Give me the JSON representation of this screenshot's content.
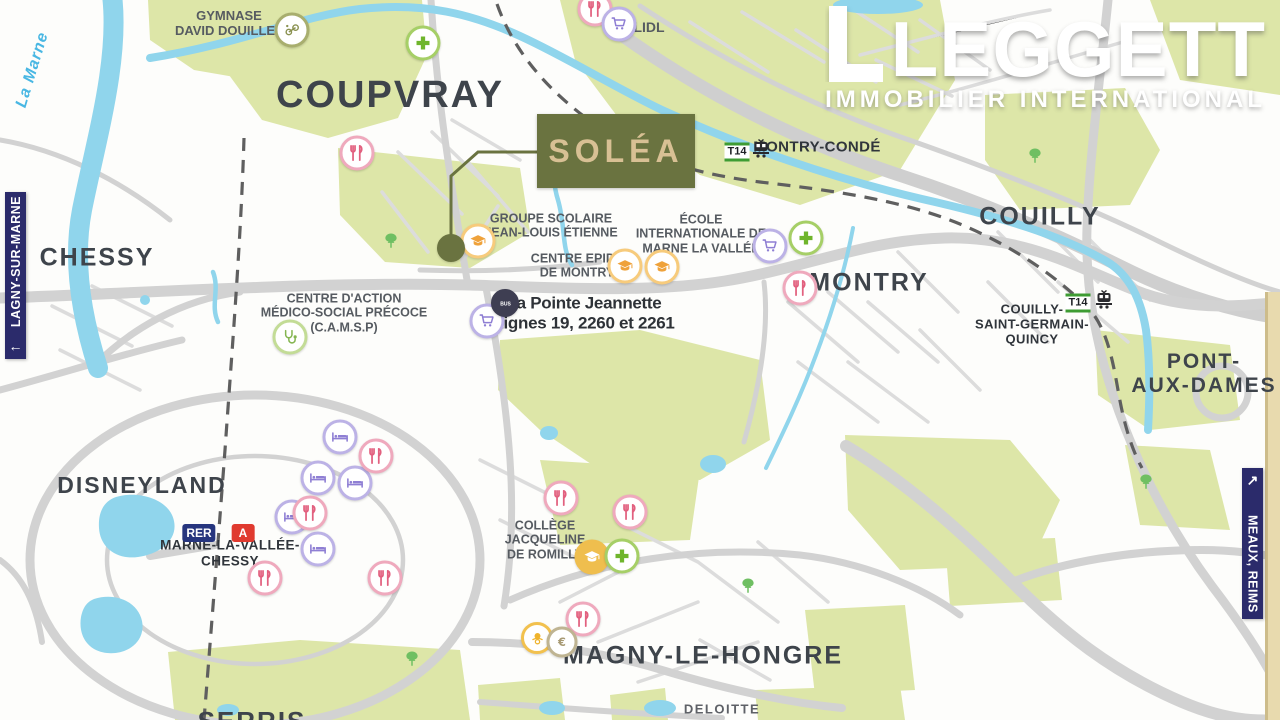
{
  "brand": {
    "name": "LEGGETT",
    "tagline": "IMMOBILIER INTERNATIONAL"
  },
  "property": {
    "name": "SOLÉA"
  },
  "banners": {
    "left": {
      "label": "LAGNY-SUR-MARNE",
      "arrow": "←"
    },
    "right": {
      "label": "MEAUX, REIMS",
      "arrow": "↗"
    }
  },
  "colors": {
    "accent_olive": "#6A7340",
    "navy": "#2B2B6B",
    "green_area": "#DDE6A8",
    "water": "#90D5EC",
    "road": "#D4D4D4",
    "line_a_red": "#E03A2F",
    "t14_green": "#3E9C33"
  },
  "map": {
    "labels": [
      {
        "name": "label-la-marne",
        "cls": "river",
        "lines": [
          "La Marne"
        ],
        "x": 33,
        "y": 70,
        "size": 16,
        "rot": -73
      },
      {
        "name": "label-gymnase-david-douillet",
        "cls": "poi",
        "lines": [
          "GYMNASE",
          "DAVID DOUILLET"
        ],
        "x": 229,
        "y": 24,
        "size": 13
      },
      {
        "name": "label-coupvray",
        "cls": "town",
        "lines": [
          "COUPVRAY"
        ],
        "x": 390,
        "y": 96,
        "size": 38
      },
      {
        "name": "label-conde-sainte-libiaire",
        "cls": "town2",
        "lines": [
          "CONDÉ-SAINTE-LIBIAIRE"
        ],
        "x": 1120,
        "y": -7,
        "size": 20
      },
      {
        "name": "label-lidl",
        "cls": "poi",
        "lines": [
          "LIDL"
        ],
        "x": 649,
        "y": 27,
        "size": 14
      },
      {
        "name": "label-montry-conde",
        "cls": "town2",
        "lines": [
          "MONTRY-CONDÉ"
        ],
        "x": 817,
        "y": 147,
        "size": 15
      },
      {
        "name": "label-chessy",
        "cls": "town",
        "lines": [
          "CHESSY"
        ],
        "x": 97,
        "y": 258,
        "size": 25
      },
      {
        "name": "label-groupe-scolaire",
        "cls": "poi",
        "lines": [
          "GROUPE SCOLAIRE",
          "JEAN-LOUIS ÉTIENNE"
        ],
        "x": 551,
        "y": 226,
        "size": 12.5
      },
      {
        "name": "label-ecole-internationale",
        "cls": "poi",
        "lines": [
          "ÉCOLE",
          "INTERNATIONALE DE",
          "MARNE LA VALLÉE"
        ],
        "x": 701,
        "y": 234,
        "size": 12.5
      },
      {
        "name": "label-centre-epide",
        "cls": "poi",
        "lines": [
          "CENTRE EPIDE",
          "DE MONTRY"
        ],
        "x": 577,
        "y": 266,
        "size": 12.5
      },
      {
        "name": "label-camsp",
        "cls": "poi",
        "lines": [
          "CENTRE D'ACTION",
          "MÉDICO-SOCIAL PRÉCOCE",
          "(C.A.M.S.P)"
        ],
        "x": 344,
        "y": 313,
        "size": 12.5
      },
      {
        "name": "label-pointe-jeannette",
        "cls": "busstop",
        "lines": [
          "La Pointe Jeannette",
          "Lignes 19, 2260 et 2261"
        ],
        "x": 584,
        "y": 313,
        "size": 17
      },
      {
        "name": "label-montry",
        "cls": "town",
        "lines": [
          "MONTRY"
        ],
        "x": 869,
        "y": 283,
        "size": 25
      },
      {
        "name": "label-couilly",
        "cls": "town",
        "lines": [
          "COUILLY"
        ],
        "x": 1040,
        "y": 217,
        "size": 25
      },
      {
        "name": "label-couilly-saint-germain-quincy",
        "cls": "town2",
        "lines": [
          "COUILLY-",
          "SAINT-GERMAIN-",
          "QUINCY"
        ],
        "x": 1032,
        "y": 325,
        "size": 13
      },
      {
        "name": "label-pont-aux-dames",
        "cls": "town",
        "lines": [
          "PONT-",
          "AUX-DAMES"
        ],
        "x": 1204,
        "y": 374,
        "size": 21
      },
      {
        "name": "label-disneyland",
        "cls": "town",
        "lines": [
          "DISNEYLAND"
        ],
        "x": 142,
        "y": 485,
        "size": 23
      },
      {
        "name": "label-marne-la-vallee-chessy",
        "cls": "town2",
        "lines": [
          "MARNE-LA-VALLÉE-",
          "CHESSY"
        ],
        "x": 230,
        "y": 553,
        "size": 13.5
      },
      {
        "name": "label-college-romilly",
        "cls": "poi",
        "lines": [
          "COLLÈGE",
          "JACQUELINE",
          "DE ROMILLY"
        ],
        "x": 545,
        "y": 540,
        "size": 12.5
      },
      {
        "name": "label-magny-le-hongre",
        "cls": "town",
        "lines": [
          "MAGNY-LE-HONGRE"
        ],
        "x": 703,
        "y": 656,
        "size": 25
      },
      {
        "name": "label-serris",
        "cls": "town",
        "lines": [
          "SERRIS"
        ],
        "x": 252,
        "y": 722,
        "size": 26
      },
      {
        "name": "label-deloitte",
        "cls": "company",
        "lines": [
          "DELOITTE"
        ],
        "x": 722,
        "y": 710,
        "size": 13
      }
    ],
    "icons": [
      {
        "type": "sports",
        "x": 292,
        "y": 30
      },
      {
        "type": "pharmacy",
        "x": 423,
        "y": 43
      },
      {
        "type": "restaurant",
        "x": 595,
        "y": 9
      },
      {
        "type": "cart",
        "x": 619,
        "y": 24
      },
      {
        "type": "restaurant",
        "x": 357,
        "y": 153
      },
      {
        "type": "school",
        "x": 478,
        "y": 241
      },
      {
        "type": "school",
        "x": 625,
        "y": 266
      },
      {
        "type": "school",
        "x": 662,
        "y": 267
      },
      {
        "type": "cart",
        "x": 770,
        "y": 246
      },
      {
        "type": "pharmacy",
        "x": 806,
        "y": 238
      },
      {
        "type": "restaurant",
        "x": 800,
        "y": 288
      },
      {
        "type": "medical",
        "x": 290,
        "y": 337
      },
      {
        "type": "cart",
        "x": 487,
        "y": 321
      },
      {
        "type": "bus",
        "x": 505,
        "y": 303
      },
      {
        "type": "bed",
        "x": 340,
        "y": 437
      },
      {
        "type": "bed",
        "x": 318,
        "y": 478
      },
      {
        "type": "bed",
        "x": 355,
        "y": 483
      },
      {
        "type": "bed",
        "x": 292,
        "y": 517
      },
      {
        "type": "bed",
        "x": 318,
        "y": 549
      },
      {
        "type": "restaurant",
        "x": 376,
        "y": 456
      },
      {
        "type": "restaurant",
        "x": 310,
        "y": 513
      },
      {
        "type": "restaurant",
        "x": 265,
        "y": 578
      },
      {
        "type": "restaurant",
        "x": 385,
        "y": 578
      },
      {
        "type": "restaurant",
        "x": 561,
        "y": 498
      },
      {
        "type": "restaurant",
        "x": 630,
        "y": 512
      },
      {
        "type": "school-filled",
        "x": 592,
        "y": 557
      },
      {
        "type": "pharmacy",
        "x": 622,
        "y": 556
      },
      {
        "type": "restaurant",
        "x": 583,
        "y": 619
      },
      {
        "type": "creche",
        "x": 537,
        "y": 638
      },
      {
        "type": "bank",
        "x": 562,
        "y": 642
      },
      {
        "type": "marker",
        "x": 451,
        "y": 248
      },
      {
        "type": "tree",
        "x": 391,
        "y": 241
      },
      {
        "type": "tree",
        "x": 1035,
        "y": 156
      },
      {
        "type": "tree",
        "x": 1146,
        "y": 482
      },
      {
        "type": "tree",
        "x": 748,
        "y": 586
      },
      {
        "type": "tree",
        "x": 412,
        "y": 659
      }
    ],
    "transit": [
      {
        "type": "t14-badge",
        "label": "T14",
        "x": 737,
        "y": 152
      },
      {
        "type": "train-icon",
        "x": 761,
        "y": 151
      },
      {
        "type": "t14-badge",
        "label": "T14",
        "x": 1078,
        "y": 303
      },
      {
        "type": "train-icon",
        "x": 1104,
        "y": 302
      },
      {
        "type": "rer-badge",
        "label": "RER",
        "x": 199,
        "y": 533
      },
      {
        "type": "line-a-badge",
        "label": "A",
        "x": 243,
        "y": 533
      }
    ]
  }
}
